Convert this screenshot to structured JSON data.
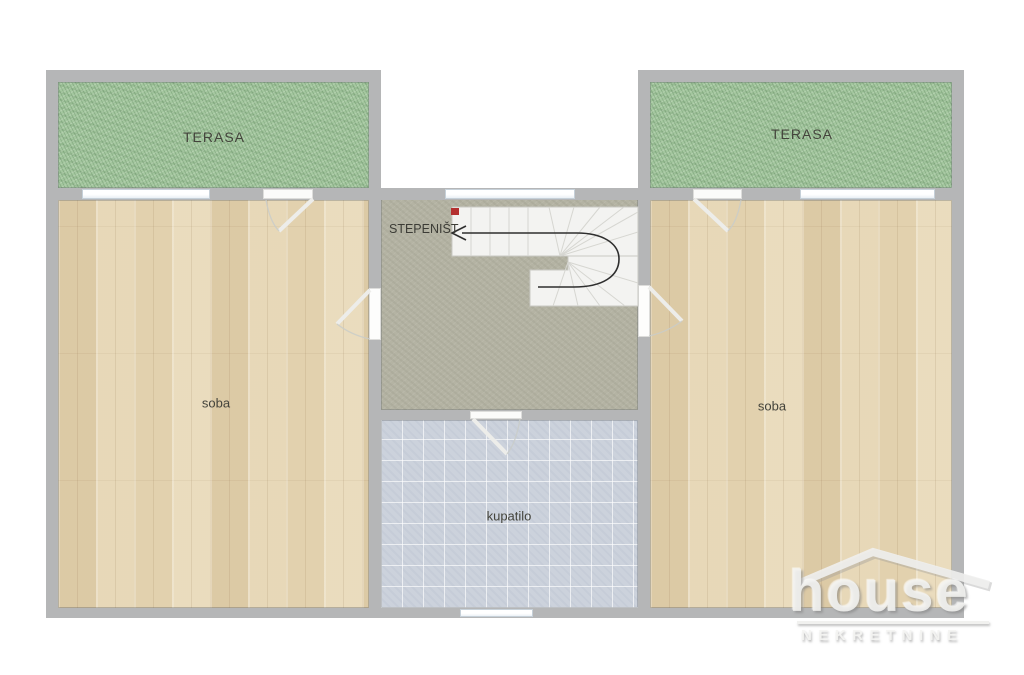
{
  "rooms": {
    "terrace_left": {
      "label": "TERASA"
    },
    "terrace_right": {
      "label": "TERASA"
    },
    "room_left": {
      "label": "soba"
    },
    "room_right": {
      "label": "soba"
    },
    "staircase": {
      "label": "STEPENIŠT"
    },
    "bathroom": {
      "label": "kupatilo"
    }
  },
  "watermark": {
    "brand": "house",
    "subtitle": "NEKRETNINE"
  },
  "colors": {
    "wall": "#b5b6b7",
    "wood_floor": "#e7d8b8",
    "terrace_green": "#a4c79f",
    "bathroom_tile": "#ccd2dc",
    "staircase_floor": "#b4b3a3",
    "stair_steps": "#f3f3f1",
    "direction_arrow": "#2e2e2e",
    "stair_start_marker": "#b43030"
  }
}
